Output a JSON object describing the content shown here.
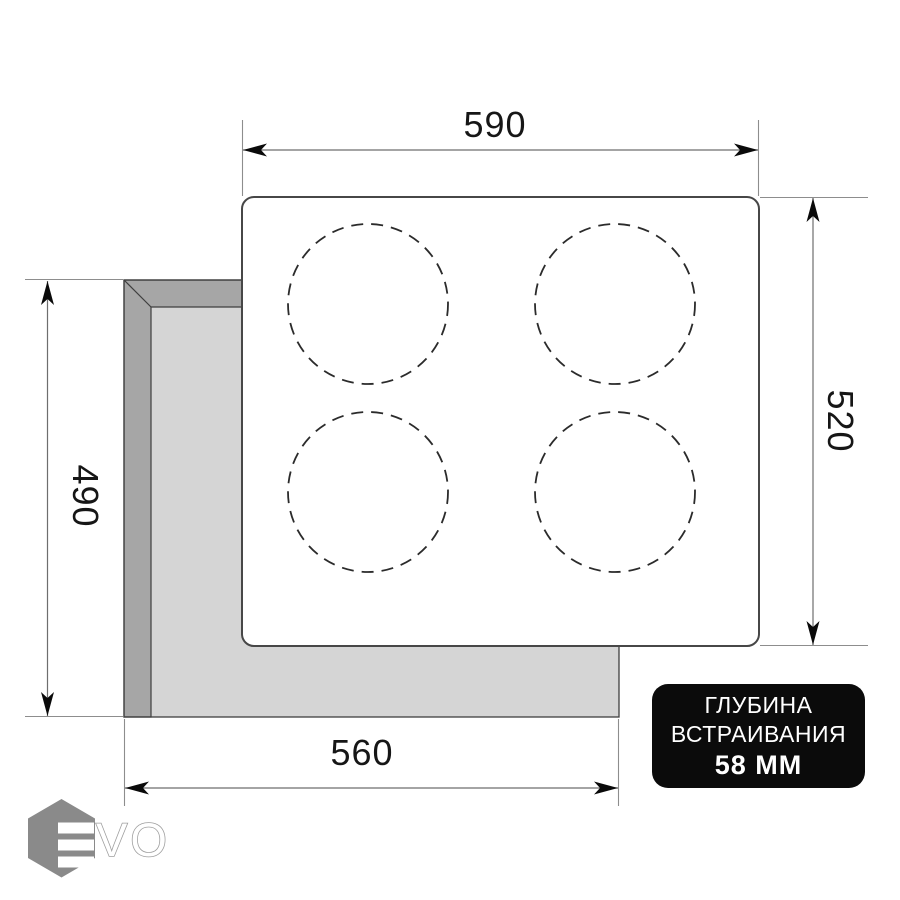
{
  "drawing": {
    "kind": "built-in hob installation diagram",
    "burner_count": 4
  },
  "dimensions": {
    "top": "590",
    "right": "520",
    "left": "490",
    "bottom": "560"
  },
  "badge": {
    "line1": "ГЛУБИНА",
    "line2": "ВСТРАИВАНИЯ",
    "line3": "58 ММ"
  },
  "logo": {
    "brand": "EVO",
    "wordmark_tail": "VO"
  },
  "colors": {
    "cutout_face": "#d5d5d5",
    "cutout_bevel": "#a6a6a6",
    "outline": "#3f3f3f",
    "panel_border": "#474747",
    "burner_dash": "#2b2b2b",
    "dim_line": "#6e6e6e",
    "ext_line": "#8d8d8d",
    "arrow": "#0a0a0a",
    "badge_bg": "#0b0b0b",
    "badge_text": "#ffffff",
    "logo_gray": "#8a8a8a",
    "logo_outline": "#9e9e9e"
  }
}
